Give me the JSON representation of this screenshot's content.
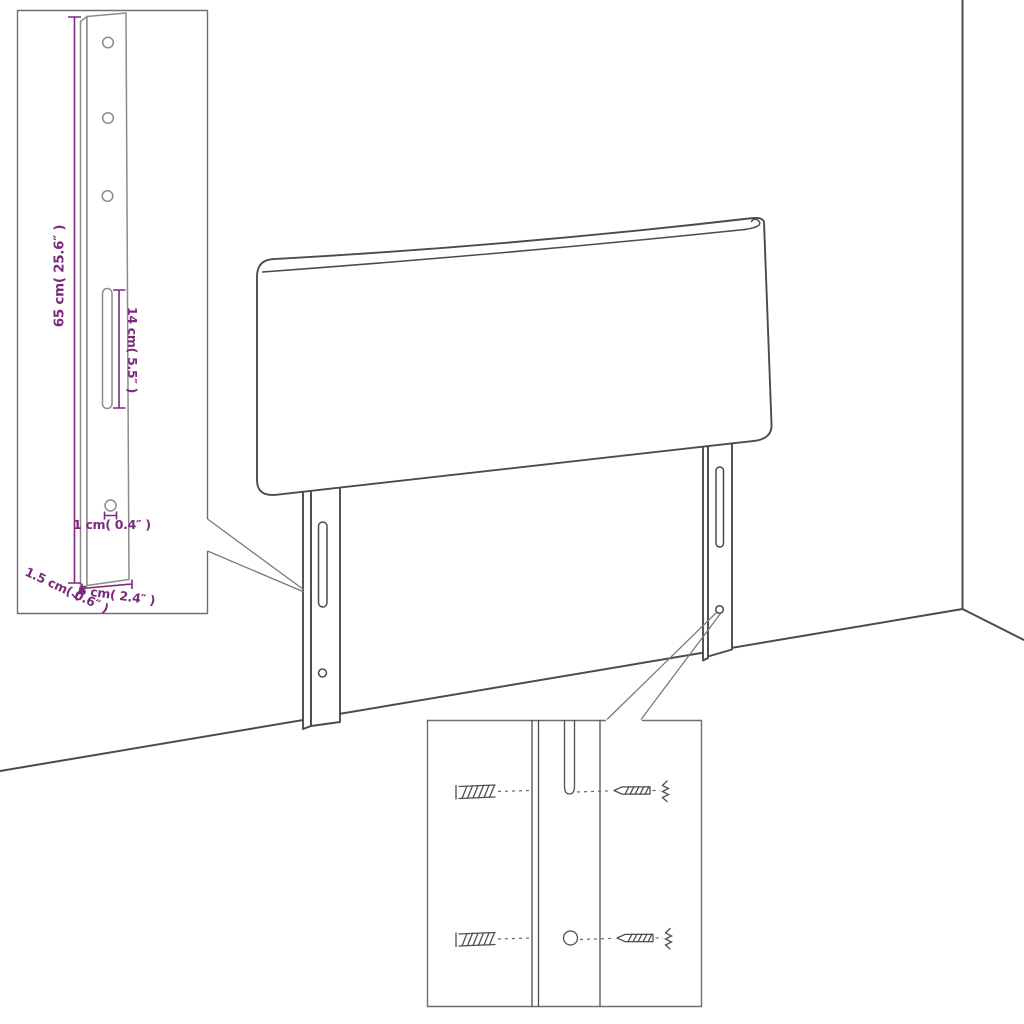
{
  "diagram": {
    "title": "headboard-assembly-diagram",
    "insets": {
      "leg_detail": {
        "dim_height": "65 cm( 25.6″ )",
        "dim_slot": "14 cm( 5.5″ )",
        "dim_hole": "1 cm( 0.4″ )",
        "dim_depth": "1.5 cm( 0.6″ )",
        "dim_width": "6 cm( 2.4″ )"
      },
      "hardware_detail": {
        "left_part": "wall-plug",
        "right_part": "screw"
      }
    },
    "colors": {
      "dimension_text": "#7b2a7b",
      "line_art": "#4b4b4b",
      "background": "#ffffff"
    }
  }
}
